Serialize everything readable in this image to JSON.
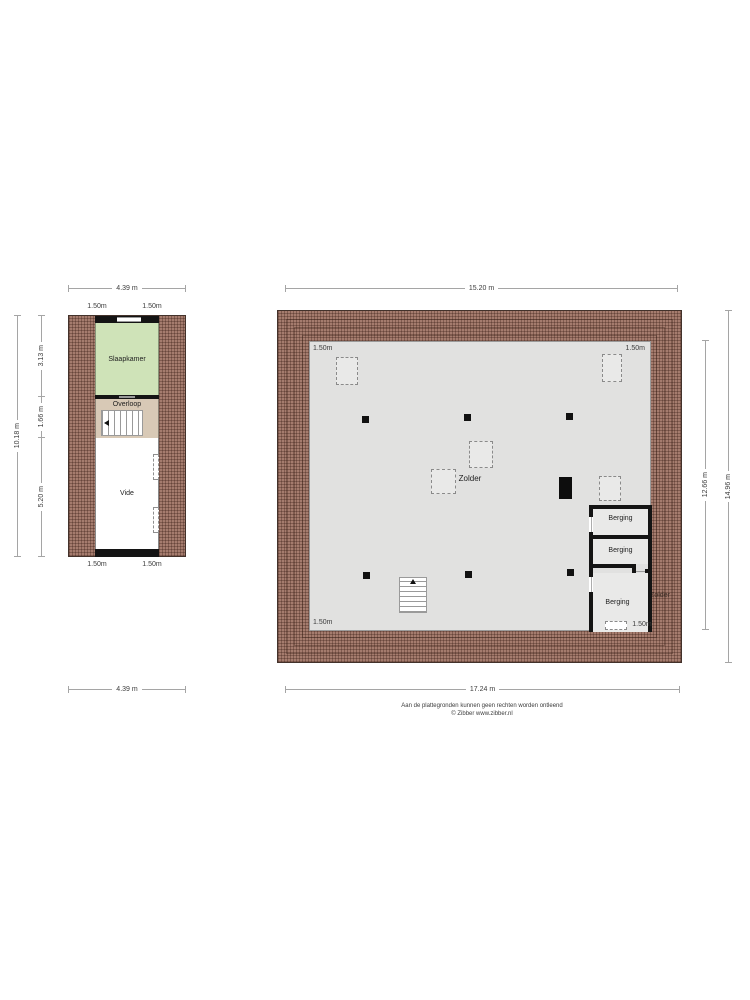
{
  "page": {
    "disclaimer_line1": "Aan de plattegronden kunnen geen rechten worden ontleend",
    "disclaimer_line2": "© Zibber www.zibber.nl"
  },
  "colors": {
    "roof_hatch": "#a57c6e",
    "wall": "#141414",
    "floor_gray": "#e1e1e0",
    "slaapkamer_green": "#cfe3b8",
    "overloop_tan": "#d8c9b6"
  },
  "small_plan": {
    "dim_top": "4.39 m",
    "dim_bottom": "4.39 m",
    "dim_left_total": "10.18 m",
    "dim_left_segments": [
      "3.13 m",
      "1.66 m",
      "5.20 m"
    ],
    "top_labels": [
      "1.50m",
      "1.50m"
    ],
    "bottom_labels": [
      "1.50m",
      "1.50m"
    ],
    "rooms": {
      "slaapkamer": "Slaapkamer",
      "overloop": "Overloop",
      "vide": "Vide"
    }
  },
  "large_plan": {
    "dim_top": "15.20 m",
    "dim_bottom": "17.24 m",
    "dim_right_inner": "12.66 m",
    "dim_right_outer": "14.96 m",
    "corner_label_top_left": "1.50m",
    "corner_label_top_right": "1.50m",
    "corner_label_bottom_left": "1.50m",
    "main_room": "Zolder",
    "roof_label": "Zolder",
    "bergings": [
      "Berging",
      "Berging",
      "Berging"
    ],
    "berging_window_label": "1.50m"
  }
}
